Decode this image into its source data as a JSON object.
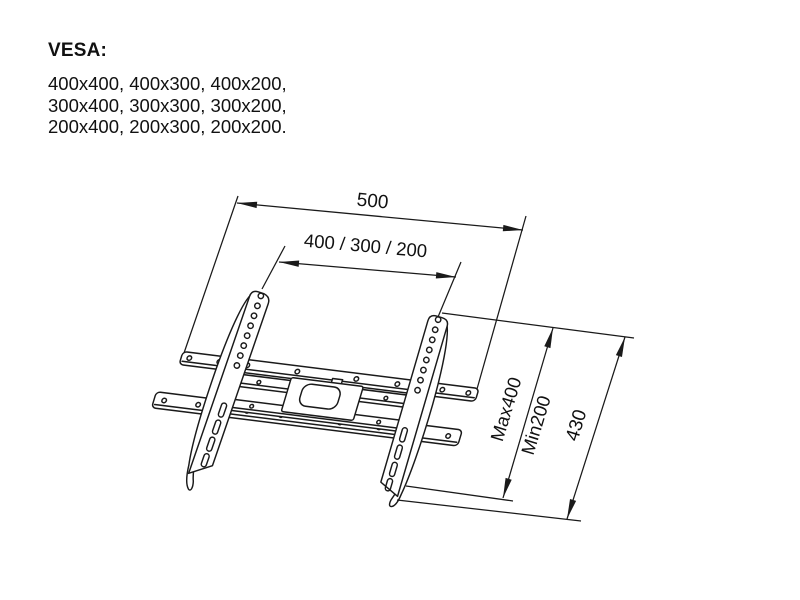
{
  "title_block": {
    "heading": "VESA:",
    "sizes": [
      "400x400, 400x300, 400x200,",
      "300x400, 300x300, 300x200,",
      "200x400, 200x300, 200x200."
    ]
  },
  "diagram": {
    "type": "wall-mount-bracket-technical-drawing",
    "labels": {
      "total_width": "500",
      "vesa_width": "400 / 300 / 200",
      "max_height": "Max400",
      "min_height": "Min200",
      "total_height": "430"
    },
    "stroke_color": "#1a1a1a",
    "background": "#ffffff"
  }
}
